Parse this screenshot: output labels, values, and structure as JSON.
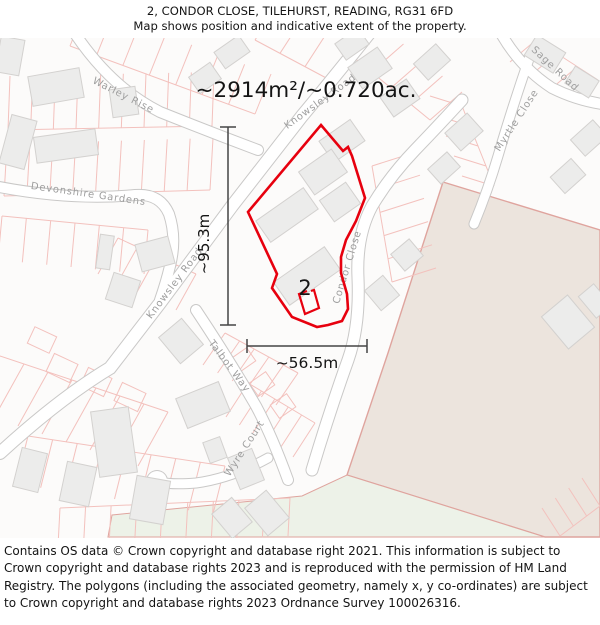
{
  "header": {
    "title": "2, CONDOR CLOSE, TILEHURST, READING, RG31 6FD",
    "subtitle": "Map shows position and indicative extent of the property."
  },
  "map": {
    "area_label": "~2914m²/~0.720ac.",
    "height_label": "~95.3m",
    "width_label": "~56.5m",
    "property_number": "2",
    "streets": [
      {
        "id": "warley-rise",
        "name": "Warley Rise"
      },
      {
        "id": "devonshire-gardens",
        "name": "Devonshire Gardens"
      },
      {
        "id": "knowsley-road",
        "name": "Knowsley Road"
      },
      {
        "id": "knowsley-road-top",
        "name": "Knowsley Road"
      },
      {
        "id": "talbot-way",
        "name": "Talbot Way"
      },
      {
        "id": "wyre-court",
        "name": "Wyre Court"
      },
      {
        "id": "condor-close",
        "name": "Condor Close"
      },
      {
        "id": "sage-road",
        "name": "Sage Road"
      },
      {
        "id": "myrtle-close",
        "name": "Myrtle Close"
      }
    ],
    "colors": {
      "property_outline": "#e7000e",
      "parcel_line": "#f3c1bd",
      "field_fill": "#ece4dd",
      "field_edge": "#dfa49e",
      "green_fill": "#edf2e8",
      "building_fill": "#ececeb",
      "building_stroke": "#d3d1cf",
      "road_casing": "#c9c8c7",
      "road_fill": "#ffffff",
      "street_label": "#9e9e9e",
      "dimension": "#454545",
      "text": "#141414",
      "background": "#fcfbfa"
    }
  },
  "footer": {
    "text": "Contains OS data © Crown copyright and database right 2021. This information is subject to Crown copyright and database rights 2023 and is reproduced with the permission of HM Land Registry. The polygons (including the associated geometry, namely x, y co-ordinates) are subject to Crown copyright and database rights 2023 Ordnance Survey 100026316."
  }
}
